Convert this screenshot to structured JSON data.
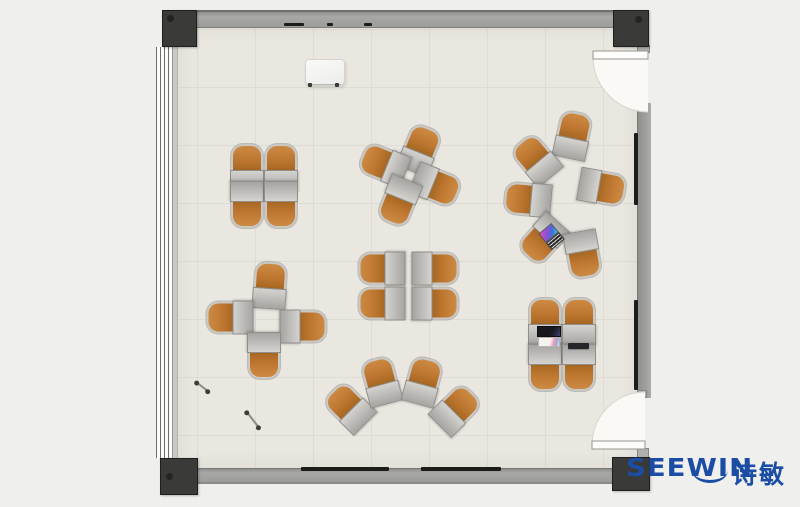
{
  "brand": {
    "name": "SEEWIN",
    "cn": "诗敏",
    "color": "#1b4da5"
  },
  "palette": {
    "outer_bg": "#efefed",
    "floor": "#e9e7e0",
    "tile_line": "#dedcd4",
    "wall_gray": "#9c9c9a",
    "column_dark": "#3a3a38",
    "chair_orange": "#bd7630",
    "chair_frame": "#c9c8c4",
    "desk_gray": "#b5b4b1",
    "door_fill": "#faf9f6",
    "rail_dark": "#1c1c1a"
  },
  "plan": {
    "room": {
      "floor_x": 177,
      "floor_y": 25,
      "floor_w": 461,
      "floor_h": 443,
      "tile_size": 58
    },
    "doors": [
      {
        "side": "right-top",
        "pivot_x": 648,
        "pivot_y": 57,
        "radius": 55
      },
      {
        "side": "right-bottom",
        "pivot_x": 645,
        "pivot_y": 445,
        "radius": 53
      }
    ]
  },
  "furniture": {
    "units": [
      {
        "cluster": "top-left-quad",
        "x": 247,
        "y": 168,
        "r": 0
      },
      {
        "cluster": "top-left-quad",
        "x": 281,
        "y": 168,
        "r": 0
      },
      {
        "cluster": "top-left-quad",
        "x": 247,
        "y": 205,
        "r": 180
      },
      {
        "cluster": "top-left-quad",
        "x": 281,
        "y": 205,
        "r": 180
      },
      {
        "cluster": "top-mid-pinwheel",
        "x": 420,
        "y": 150,
        "r": 22
      },
      {
        "cluster": "top-mid-pinwheel",
        "x": 384,
        "y": 165,
        "r": -68
      },
      {
        "cluster": "top-mid-pinwheel",
        "x": 436,
        "y": 186,
        "r": 112
      },
      {
        "cluster": "top-mid-pinwheel",
        "x": 399,
        "y": 202,
        "r": 202
      },
      {
        "cluster": "right-circle",
        "x": 573,
        "y": 136,
        "r": 12
      },
      {
        "cluster": "right-circle",
        "x": 536,
        "y": 160,
        "r": -40
      },
      {
        "cluster": "right-circle",
        "x": 528,
        "y": 200,
        "r": -85
      },
      {
        "cluster": "right-circle",
        "x": 602,
        "y": 188,
        "r": 100
      },
      {
        "cluster": "right-circle",
        "x": 543,
        "y": 240,
        "r": -138
      },
      {
        "cluster": "right-circle",
        "x": 583,
        "y": 255,
        "r": 170
      },
      {
        "cluster": "left-mid-cross",
        "x": 270,
        "y": 286,
        "r": 4
      },
      {
        "cluster": "left-mid-cross",
        "x": 230,
        "y": 318,
        "r": -90
      },
      {
        "cluster": "left-mid-cross",
        "x": 303,
        "y": 327,
        "r": 90
      },
      {
        "cluster": "left-mid-cross",
        "x": 264,
        "y": 356,
        "r": 180
      },
      {
        "cluster": "center-quad",
        "x": 382,
        "y": 269,
        "r": -90
      },
      {
        "cluster": "center-quad",
        "x": 435,
        "y": 269,
        "r": 90
      },
      {
        "cluster": "center-quad",
        "x": 382,
        "y": 304,
        "r": -90
      },
      {
        "cluster": "center-quad",
        "x": 435,
        "y": 304,
        "r": 90
      },
      {
        "cluster": "bottom-fan",
        "x": 349,
        "y": 408,
        "r": -45
      },
      {
        "cluster": "bottom-fan",
        "x": 381,
        "y": 382,
        "r": -15
      },
      {
        "cluster": "bottom-fan",
        "x": 423,
        "y": 382,
        "r": 15
      },
      {
        "cluster": "bottom-fan",
        "x": 456,
        "y": 410,
        "r": 45
      },
      {
        "cluster": "bottom-right-quad",
        "x": 545,
        "y": 322,
        "r": 0
      },
      {
        "cluster": "bottom-right-quad",
        "x": 579,
        "y": 322,
        "r": 0
      },
      {
        "cluster": "bottom-right-quad",
        "x": 545,
        "y": 368,
        "r": 180
      },
      {
        "cluster": "bottom-right-quad",
        "x": 579,
        "y": 368,
        "r": 180
      }
    ],
    "items": [
      {
        "type": "whiteboard",
        "x": 324,
        "y": 72,
        "rot": 0
      },
      {
        "type": "laptop-color",
        "x": 552,
        "y": 236,
        "rot": -40
      },
      {
        "type": "laptop-dark",
        "x": 549,
        "y": 337,
        "rot": 0
      },
      {
        "type": "tablet",
        "x": 578,
        "y": 346,
        "rot": 0
      },
      {
        "type": "stick",
        "x": 202,
        "y": 387,
        "rot": 38,
        "len": 15
      },
      {
        "type": "stick",
        "x": 253,
        "y": 420,
        "rot": 52,
        "len": 20
      }
    ]
  },
  "fixtures": {
    "rails": [
      {
        "x": 284,
        "y": 23,
        "w": 20,
        "h": 3
      },
      {
        "x": 327,
        "y": 23,
        "w": 6,
        "h": 3
      },
      {
        "x": 364,
        "y": 23,
        "w": 8,
        "h": 3
      },
      {
        "x": 301,
        "y": 467,
        "w": 88,
        "h": 4
      },
      {
        "x": 421,
        "y": 467,
        "w": 80,
        "h": 4
      },
      {
        "x": 634,
        "y": 133,
        "w": 4,
        "h": 72
      },
      {
        "x": 634,
        "y": 300,
        "w": 4,
        "h": 90
      }
    ]
  }
}
